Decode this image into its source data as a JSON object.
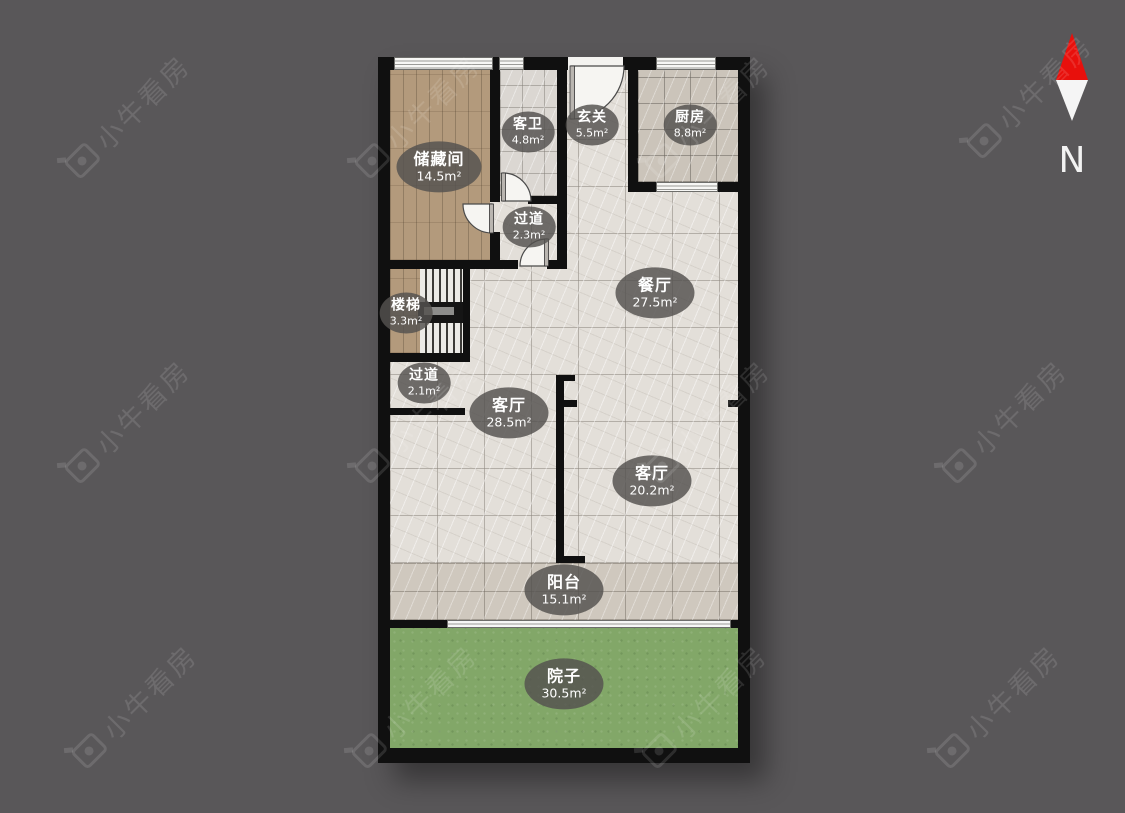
{
  "title": "residential floor plan",
  "watermark": {
    "text": "小牛看房"
  },
  "compass": {
    "label": "N"
  },
  "rooms": [
    {
      "id": "storage",
      "name": "储藏间",
      "area": "14.5m²"
    },
    {
      "id": "guest-bath",
      "name": "客卫",
      "area": "4.8m²"
    },
    {
      "id": "entry-hall",
      "name": "玄关",
      "area": "5.5m²"
    },
    {
      "id": "kitchen",
      "name": "厨房",
      "area": "8.8m²"
    },
    {
      "id": "corridor-upper",
      "name": "过道",
      "area": "2.3m²"
    },
    {
      "id": "stairs",
      "name": "楼梯",
      "area": "3.3m²"
    },
    {
      "id": "dining",
      "name": "餐厅",
      "area": "27.5m²"
    },
    {
      "id": "corridor-lower",
      "name": "过道",
      "area": "2.1m²"
    },
    {
      "id": "living-west",
      "name": "客厅",
      "area": "28.5m²"
    },
    {
      "id": "living-east",
      "name": "客厅",
      "area": "20.2m²"
    },
    {
      "id": "balcony",
      "name": "阳台",
      "area": "15.1m²"
    },
    {
      "id": "yard",
      "name": "院子",
      "area": "30.5m²"
    }
  ],
  "colors": {
    "background": "#595759",
    "wall": "#101010",
    "tile_light": "#e3dfd9",
    "tile_kitchen": "#cbc4ba",
    "tile_balcony": "#cfc8be",
    "wood": "#b39a7c",
    "grass": "#82a768",
    "label_bg": "rgba(84,82,79,0.83)",
    "compass_red": "#e8100c"
  }
}
